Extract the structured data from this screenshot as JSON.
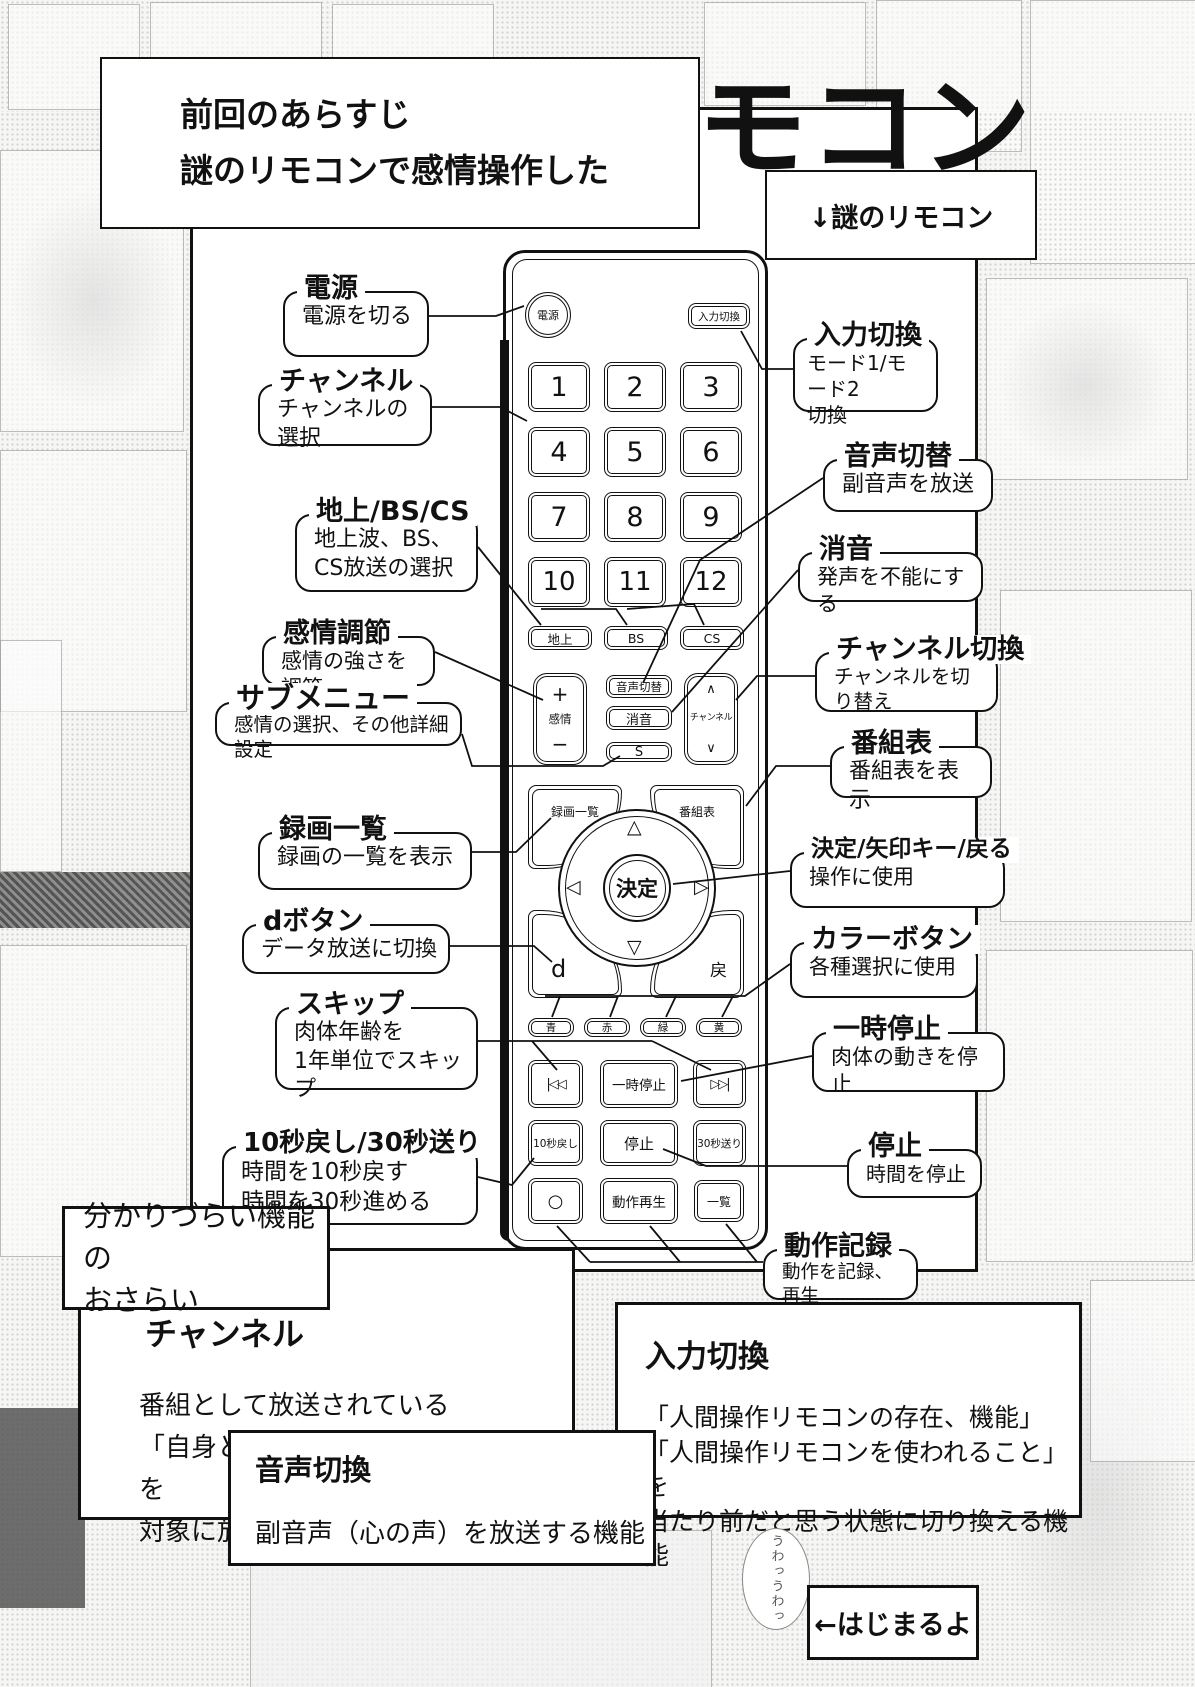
{
  "header": {
    "recap_line1": "前回のあらすじ",
    "recap_line2": "謎のリモコンで感情操作した",
    "big_title": "リモコン",
    "arrow_label": "↓謎のリモコン"
  },
  "remote": {
    "power": "電源",
    "input": "入力切換",
    "numbers": [
      "1",
      "2",
      "3",
      "4",
      "5",
      "6",
      "7",
      "8",
      "9",
      "10",
      "11",
      "12"
    ],
    "bands": [
      "地上",
      "BS",
      "CS"
    ],
    "emotion": {
      "plus": "+",
      "label": "感情",
      "minus": "−"
    },
    "audio": "音声切替",
    "mute": "消音",
    "s": "S",
    "channel": {
      "up": "∧",
      "label": "チャンネル",
      "down": "∨"
    },
    "rec_list": "録画一覧",
    "guide": "番組表",
    "enter": "決定",
    "pad": {
      "up": "△",
      "down": "▽",
      "left": "◁",
      "right": "▷"
    },
    "d": "d",
    "back": "戻",
    "colors": [
      "青",
      "赤",
      "緑",
      "黄"
    ],
    "skip_back": "|◁◁",
    "pause": "一時停止",
    "skip_fwd": "▷▷|",
    "back10": "10秒戻し",
    "stop": "停止",
    "fwd30": "30秒送り",
    "record_circle": "○",
    "replay": "動作再生",
    "list": "一覧"
  },
  "callouts_left": [
    {
      "title": "電源",
      "desc": [
        "電源を切る"
      ]
    },
    {
      "title": "チャンネル",
      "desc": [
        "チャンネルの選択"
      ]
    },
    {
      "title": "地上/BS/CS",
      "desc": [
        "地上波、BS、",
        "CS放送の選択"
      ]
    },
    {
      "title": "感情調節",
      "desc": [
        "感情の強さを調節"
      ]
    },
    {
      "title": "サブメニュー",
      "desc": [
        "感情の選択、その他詳細設定"
      ]
    },
    {
      "title": "録画一覧",
      "desc": [
        "録画の一覧を表示"
      ]
    },
    {
      "title": "dボタン",
      "desc": [
        "データ放送に切換"
      ]
    },
    {
      "title": "スキップ",
      "desc": [
        "肉体年齢を",
        "1年単位でスキップ"
      ]
    },
    {
      "title": "10秒戻し/30秒送り",
      "desc": [
        "時間を10秒戻す",
        "時間を30秒進める"
      ]
    }
  ],
  "callouts_right": [
    {
      "title": "入力切換",
      "desc": [
        "モード1/モード2",
        "切換"
      ]
    },
    {
      "title": "音声切替",
      "desc": [
        "副音声を放送"
      ]
    },
    {
      "title": "消音",
      "desc": [
        "発声を不能にする"
      ]
    },
    {
      "title": "チャンネル切換",
      "desc": [
        "チャンネルを切り替え"
      ]
    },
    {
      "title": "番組表",
      "desc": [
        "番組表を表示"
      ]
    },
    {
      "title": "決定/矢印キー/戻る",
      "desc": [
        "操作に使用"
      ]
    },
    {
      "title": "カラーボタン",
      "desc": [
        "各種選択に使用"
      ]
    },
    {
      "title": "一時停止",
      "desc": [
        "肉体の動きを停止"
      ]
    },
    {
      "title": "停止",
      "desc": [
        "時間を停止"
      ]
    },
    {
      "title": "動作記録",
      "desc": [
        "動作を記録、再生"
      ]
    }
  ],
  "footer": {
    "recap_line1": "分かりづらい機能の",
    "recap_line2": "おさらい",
    "channel_title": "チャンネル",
    "channel_body1": "番組として放送されている",
    "channel_body2": "「自身との関係性」や「人格」などを",
    "channel_body3": "対象に放映することができる機能",
    "input_title": "入力切換",
    "input_body1": "「人間操作リモコンの存在、機能」",
    "input_body2": "「人間操作リモコンを使われること」を",
    "input_body3": "当たり前だと思う状態に切り換える機能",
    "audio_title": "音声切換",
    "audio_body1": "副音声（心の声）を放送する機能",
    "start_label": "←はじまるよ",
    "bubble": "うわっうわっ"
  }
}
